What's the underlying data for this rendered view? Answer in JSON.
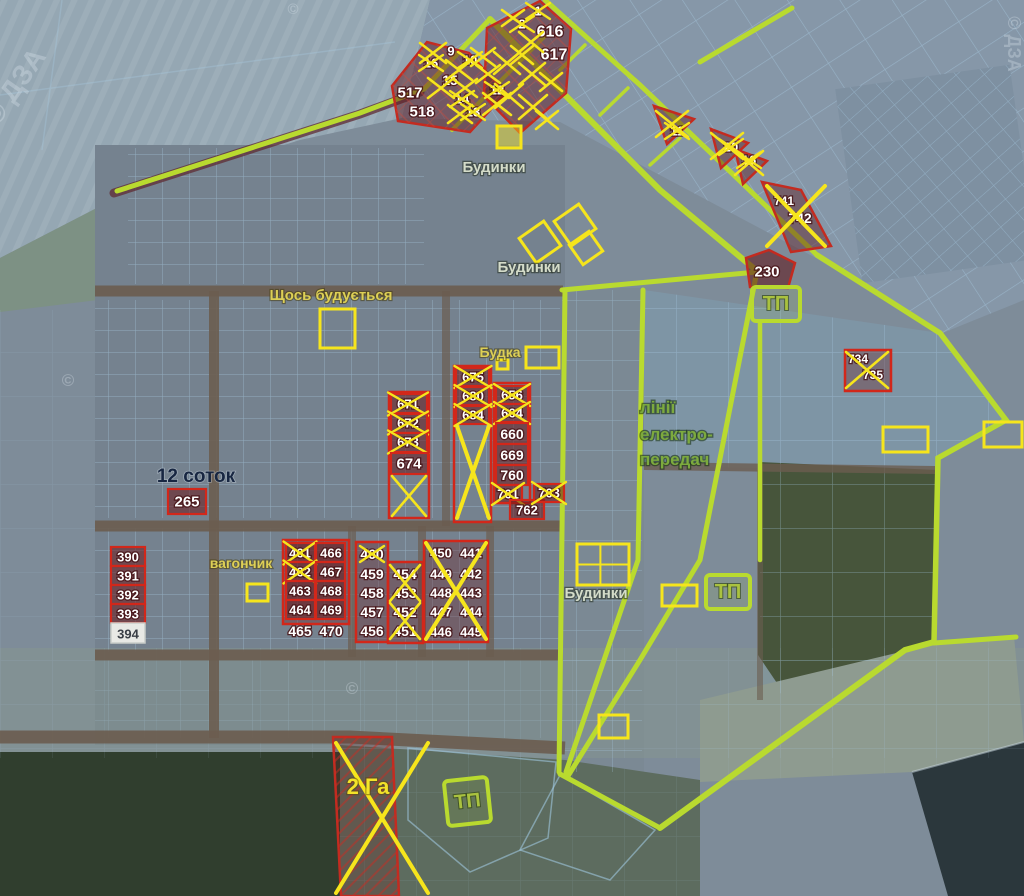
{
  "colors": {
    "lime_road": "#b9da2f",
    "yellow_mark": "#f6e51c",
    "red_plot": "#d2271a",
    "dark_red_fill": "rgba(105,25,28,0.55)",
    "grid_blue": "#a9cde6",
    "road_brown": "#6b5d50",
    "white": "#ffffff"
  },
  "tp": {
    "label": "ТП"
  },
  "watermarks": [
    {
      "text": "© ДЗА",
      "x": 22,
      "y": 92,
      "rot": -55,
      "size": 28
    },
    {
      "text": "©",
      "x": 293,
      "y": 14,
      "rot": 0,
      "size": 15
    },
    {
      "text": "©",
      "x": 68,
      "y": 386,
      "rot": 0,
      "size": 17
    },
    {
      "text": "©",
      "x": 352,
      "y": 694,
      "rot": 0,
      "size": 17
    },
    {
      "text": "© ДЗА",
      "x": 1008,
      "y": 44,
      "rot": 90,
      "size": 18
    }
  ],
  "labels": [
    {
      "id": "budynky-top",
      "text": "Будинки",
      "x": 494,
      "y": 172,
      "cls": "light",
      "size": 15
    },
    {
      "id": "budynky-mid",
      "text": "Будинки",
      "x": 529,
      "y": 272,
      "cls": "light",
      "size": 15
    },
    {
      "id": "budynky-bottom",
      "text": "Будинки",
      "x": 596,
      "y": 598,
      "cls": "light",
      "size": 15
    },
    {
      "id": "shchos-buduyetsya",
      "text": "Щось будується",
      "x": 331,
      "y": 300,
      "cls": "yellow",
      "size": 15
    },
    {
      "id": "budka",
      "text": "Будка",
      "x": 500,
      "y": 357,
      "cls": "yellow",
      "size": 14
    },
    {
      "id": "power-line-1",
      "text": "лінії",
      "x": 640,
      "y": 413,
      "cls": "green",
      "size": 17,
      "anchor": "start"
    },
    {
      "id": "power-line-2",
      "text": "електро-",
      "x": 640,
      "y": 440,
      "cls": "green",
      "size": 17,
      "anchor": "start"
    },
    {
      "id": "power-line-3",
      "text": "передач",
      "x": 640,
      "y": 465,
      "cls": "green",
      "size": 17,
      "anchor": "start"
    },
    {
      "id": "sotok-12",
      "text": "12 соток",
      "x": 196,
      "y": 482,
      "cls": "dark",
      "size": 19
    },
    {
      "id": "vagonchyk",
      "text": "вагончик",
      "x": 241,
      "y": 568,
      "cls": "yellow",
      "size": 14
    },
    {
      "id": "ga-2",
      "text": "2 Га",
      "x": 368,
      "y": 794,
      "cls": "ybig",
      "size": 22
    }
  ],
  "plots": [
    {
      "n": "9",
      "x": 451,
      "y": 51,
      "style": "t",
      "size": 13
    },
    {
      "n": "16",
      "x": 431,
      "y": 63,
      "style": "t",
      "size": 13,
      "crossed": true
    },
    {
      "n": "10",
      "x": 470,
      "y": 60,
      "style": "t",
      "size": 13,
      "crossed": true
    },
    {
      "n": "15",
      "x": 450,
      "y": 80,
      "style": "t",
      "size": 14
    },
    {
      "n": "517",
      "x": 410,
      "y": 93,
      "style": "t",
      "size": 15
    },
    {
      "n": "518",
      "x": 422,
      "y": 112,
      "style": "t",
      "size": 15
    },
    {
      "n": "14",
      "x": 462,
      "y": 99,
      "style": "t",
      "size": 13,
      "crossed": true
    },
    {
      "n": "13",
      "x": 473,
      "y": 112,
      "style": "t",
      "size": 13,
      "crossed": true
    },
    {
      "n": "12",
      "x": 497,
      "y": 90,
      "style": "t",
      "size": 13,
      "crossed": true
    },
    {
      "n": "1",
      "x": 538,
      "y": 11,
      "style": "t",
      "size": 13,
      "crossed": true
    },
    {
      "n": "2",
      "x": 522,
      "y": 24,
      "style": "t",
      "size": 13,
      "crossed": true
    },
    {
      "n": "616",
      "x": 550,
      "y": 32,
      "style": "t",
      "size": 16
    },
    {
      "n": "617",
      "x": 554,
      "y": 55,
      "style": "t",
      "size": 16
    },
    {
      "n": "11",
      "x": 677,
      "y": 131,
      "style": "t",
      "size": 13,
      "crossed": true
    },
    {
      "n": "20",
      "x": 731,
      "y": 147,
      "style": "t",
      "size": 13,
      "crossed": true
    },
    {
      "n": "16",
      "x": 749,
      "y": 160,
      "style": "t",
      "size": 13,
      "crossed": true
    },
    {
      "n": "741",
      "x": 784,
      "y": 201,
      "style": "t",
      "size": 12
    },
    {
      "n": "742",
      "x": 800,
      "y": 218,
      "style": "t",
      "size": 14
    },
    {
      "n": "230",
      "x": 767,
      "y": 272,
      "style": "t",
      "size": 15
    },
    {
      "n": "734",
      "x": 858,
      "y": 359,
      "style": "t",
      "size": 12
    },
    {
      "n": "735",
      "x": 873,
      "y": 375,
      "style": "t",
      "size": 12
    },
    {
      "n": "671",
      "x": 408,
      "y": 404,
      "box": [
        391,
        394,
        36,
        19
      ],
      "style": "r",
      "size": 13,
      "crossed": true
    },
    {
      "n": "672",
      "x": 408,
      "y": 423,
      "box": [
        391,
        414,
        36,
        19
      ],
      "style": "r",
      "size": 13,
      "crossed": true
    },
    {
      "n": "673",
      "x": 408,
      "y": 442,
      "box": [
        391,
        433,
        36,
        19
      ],
      "style": "r",
      "size": 13,
      "crossed": true
    },
    {
      "n": "674",
      "x": 409,
      "y": 464,
      "box": [
        391,
        453,
        37,
        21
      ],
      "style": "r",
      "size": 15
    },
    {
      "n": "675",
      "x": 473,
      "y": 377,
      "box": [
        456,
        368,
        33,
        18
      ],
      "style": "r",
      "size": 13,
      "crossed": true
    },
    {
      "n": "680",
      "x": 473,
      "y": 396,
      "box": [
        456,
        387,
        33,
        18
      ],
      "style": "r",
      "size": 13,
      "crossed": true
    },
    {
      "n": "684",
      "x": 473,
      "y": 415,
      "box": [
        456,
        406,
        33,
        18
      ],
      "style": "r",
      "size": 13,
      "crossed": true
    },
    {
      "n": "656",
      "x": 512,
      "y": 395,
      "box": [
        496,
        386,
        32,
        18
      ],
      "style": "r",
      "size": 13,
      "crossed": true
    },
    {
      "n": "664",
      "x": 512,
      "y": 413,
      "box": [
        496,
        404,
        32,
        18
      ],
      "style": "r",
      "size": 13,
      "crossed": true
    },
    {
      "n": "660",
      "x": 512,
      "y": 434,
      "box": [
        496,
        423,
        32,
        21
      ],
      "style": "r",
      "size": 14
    },
    {
      "n": "669",
      "x": 512,
      "y": 455,
      "box": [
        496,
        444,
        32,
        21
      ],
      "style": "r",
      "size": 14
    },
    {
      "n": "760",
      "x": 512,
      "y": 475,
      "box": [
        496,
        465,
        32,
        20
      ],
      "style": "r",
      "size": 14
    },
    {
      "n": "761",
      "x": 508,
      "y": 494,
      "box": [
        494,
        485,
        28,
        18
      ],
      "style": "r",
      "size": 13,
      "crossed": true
    },
    {
      "n": "762",
      "x": 527,
      "y": 510,
      "box": [
        510,
        500,
        34,
        19
      ],
      "style": "r",
      "size": 13
    },
    {
      "n": "763",
      "x": 549,
      "y": 493,
      "box": [
        534,
        484,
        30,
        18
      ],
      "style": "r",
      "size": 13,
      "crossed": true
    },
    {
      "n": "265",
      "x": 187,
      "y": 502,
      "box": [
        168,
        489,
        38,
        25
      ],
      "style": "r",
      "size": 15
    },
    {
      "n": "390",
      "x": 128,
      "y": 557,
      "box": [
        111,
        547,
        34,
        19
      ],
      "style": "r",
      "size": 13
    },
    {
      "n": "391",
      "x": 128,
      "y": 576,
      "box": [
        111,
        566,
        34,
        19
      ],
      "style": "r",
      "size": 13
    },
    {
      "n": "392",
      "x": 128,
      "y": 595,
      "box": [
        111,
        585,
        34,
        19
      ],
      "style": "r",
      "size": 13
    },
    {
      "n": "393",
      "x": 128,
      "y": 614,
      "box": [
        111,
        604,
        34,
        19
      ],
      "style": "r",
      "size": 13
    },
    {
      "n": "394",
      "x": 128,
      "y": 634,
      "box": [
        111,
        623,
        34,
        20
      ],
      "style": "w",
      "size": 13
    },
    {
      "n": "461",
      "x": 300,
      "y": 553,
      "box": [
        286,
        543,
        29,
        19
      ],
      "style": "r",
      "size": 13,
      "crossed": true
    },
    {
      "n": "466",
      "x": 331,
      "y": 553,
      "box": [
        316,
        543,
        29,
        19
      ],
      "style": "r",
      "size": 13
    },
    {
      "n": "462",
      "x": 300,
      "y": 572,
      "box": [
        286,
        562,
        29,
        19
      ],
      "style": "r",
      "size": 13,
      "crossed": true
    },
    {
      "n": "467",
      "x": 331,
      "y": 572,
      "box": [
        316,
        562,
        29,
        19
      ],
      "style": "r",
      "size": 13
    },
    {
      "n": "463",
      "x": 300,
      "y": 591,
      "box": [
        286,
        581,
        29,
        19
      ],
      "style": "r",
      "size": 13
    },
    {
      "n": "468",
      "x": 331,
      "y": 591,
      "box": [
        316,
        581,
        29,
        19
      ],
      "style": "r",
      "size": 13
    },
    {
      "n": "464",
      "x": 300,
      "y": 610,
      "box": [
        286,
        600,
        29,
        19
      ],
      "style": "r",
      "size": 13
    },
    {
      "n": "469",
      "x": 331,
      "y": 610,
      "box": [
        316,
        600,
        29,
        19
      ],
      "style": "r",
      "size": 13
    },
    {
      "n": "465",
      "x": 300,
      "y": 631,
      "style": "t",
      "size": 14
    },
    {
      "n": "470",
      "x": 331,
      "y": 631,
      "style": "t",
      "size": 14
    },
    {
      "n": "460",
      "x": 372,
      "y": 554,
      "style": "t",
      "size": 14,
      "crossed": true
    },
    {
      "n": "459",
      "x": 372,
      "y": 574,
      "style": "t",
      "size": 14
    },
    {
      "n": "458",
      "x": 372,
      "y": 593,
      "style": "t",
      "size": 14
    },
    {
      "n": "457",
      "x": 372,
      "y": 612,
      "style": "t",
      "size": 14
    },
    {
      "n": "456",
      "x": 372,
      "y": 631,
      "style": "t",
      "size": 14
    },
    {
      "n": "454",
      "x": 405,
      "y": 574,
      "style": "t",
      "size": 14
    },
    {
      "n": "453",
      "x": 405,
      "y": 593,
      "style": "t",
      "size": 14
    },
    {
      "n": "452",
      "x": 405,
      "y": 612,
      "style": "t",
      "size": 14
    },
    {
      "n": "451",
      "x": 405,
      "y": 631,
      "style": "t",
      "size": 14
    },
    {
      "n": "450",
      "x": 441,
      "y": 553,
      "style": "t",
      "size": 13
    },
    {
      "n": "449",
      "x": 441,
      "y": 574,
      "style": "t",
      "size": 13
    },
    {
      "n": "448",
      "x": 441,
      "y": 593,
      "style": "t",
      "size": 13
    },
    {
      "n": "447",
      "x": 441,
      "y": 612,
      "style": "t",
      "size": 13
    },
    {
      "n": "446",
      "x": 441,
      "y": 632,
      "style": "t",
      "size": 13
    },
    {
      "n": "441",
      "x": 471,
      "y": 553,
      "style": "t",
      "size": 13
    },
    {
      "n": "442",
      "x": 471,
      "y": 574,
      "style": "t",
      "size": 13
    },
    {
      "n": "443",
      "x": 471,
      "y": 593,
      "style": "t",
      "size": 13
    },
    {
      "n": "444",
      "x": 471,
      "y": 612,
      "style": "t",
      "size": 13
    },
    {
      "n": "445",
      "x": 471,
      "y": 632,
      "style": "t",
      "size": 13
    }
  ],
  "block_outlines": [
    {
      "box": [
        283,
        540,
        66,
        84
      ],
      "fill": true
    },
    {
      "box": [
        356,
        542,
        32,
        100
      ],
      "fill": true
    },
    {
      "box": [
        388,
        562,
        35,
        81
      ],
      "fill": true
    },
    {
      "box": [
        424,
        541,
        64,
        101
      ],
      "fill": true
    },
    {
      "box": [
        845,
        350,
        46,
        41
      ],
      "fill": true
    },
    {
      "box": [
        389,
        392,
        40,
        126
      ],
      "fill": false
    },
    {
      "box": [
        454,
        366,
        37,
        156
      ],
      "fill": false
    },
    {
      "box": [
        494,
        383,
        36,
        120
      ],
      "fill": false
    }
  ],
  "x_marks": [
    {
      "x": 433,
      "y": 53,
      "w": 26,
      "h": 20
    },
    {
      "x": 459,
      "y": 70,
      "w": 26,
      "h": 20
    },
    {
      "x": 483,
      "y": 57,
      "w": 24,
      "h": 18
    },
    {
      "x": 441,
      "y": 88,
      "w": 26,
      "h": 20
    },
    {
      "x": 465,
      "y": 88,
      "w": 24,
      "h": 18
    },
    {
      "x": 488,
      "y": 74,
      "w": 24,
      "h": 18
    },
    {
      "x": 497,
      "y": 104,
      "w": 28,
      "h": 22
    },
    {
      "x": 460,
      "y": 114,
      "w": 24,
      "h": 18
    },
    {
      "x": 513,
      "y": 18,
      "w": 22,
      "h": 16
    },
    {
      "x": 531,
      "y": 42,
      "w": 24,
      "h": 20
    },
    {
      "x": 507,
      "y": 63,
      "w": 26,
      "h": 22
    },
    {
      "x": 532,
      "y": 74,
      "w": 26,
      "h": 22
    },
    {
      "x": 551,
      "y": 82,
      "w": 22,
      "h": 18
    },
    {
      "x": 509,
      "y": 96,
      "w": 28,
      "h": 24
    },
    {
      "x": 533,
      "y": 107,
      "w": 28,
      "h": 24
    },
    {
      "x": 547,
      "y": 120,
      "w": 22,
      "h": 18
    },
    {
      "x": 522,
      "y": 55,
      "w": 22,
      "h": 18
    },
    {
      "x": 672,
      "y": 124,
      "w": 32,
      "h": 26
    },
    {
      "x": 727,
      "y": 146,
      "w": 32,
      "h": 26
    },
    {
      "x": 749,
      "y": 163,
      "w": 28,
      "h": 24
    },
    {
      "x": 796,
      "y": 216,
      "w": 58,
      "h": 60
    },
    {
      "x": 867,
      "y": 370,
      "w": 42,
      "h": 36
    },
    {
      "x": 409,
      "y": 496,
      "w": 34,
      "h": 40
    },
    {
      "x": 473,
      "y": 472,
      "w": 32,
      "h": 92
    },
    {
      "x": 405,
      "y": 583,
      "w": 30,
      "h": 36
    },
    {
      "x": 405,
      "y": 621,
      "w": 30,
      "h": 36
    },
    {
      "x": 456,
      "y": 591,
      "w": 60,
      "h": 96
    },
    {
      "x": 382,
      "y": 818,
      "w": 92,
      "h": 150
    }
  ],
  "highlights": [
    {
      "box": [
        497,
        126,
        24,
        22
      ],
      "fill": true
    },
    {
      "box": [
        525,
        227,
        30,
        30
      ],
      "rot": -35
    },
    {
      "box": [
        560,
        210,
        30,
        30
      ],
      "rot": -35
    },
    {
      "box": [
        574,
        236,
        24,
        24
      ],
      "rot": -35
    },
    {
      "box": [
        320,
        309,
        35,
        39
      ]
    },
    {
      "box": [
        497,
        360,
        11,
        9
      ]
    },
    {
      "box": [
        526,
        347,
        33,
        21
      ]
    },
    {
      "box": [
        577,
        544,
        52,
        41
      ],
      "grid": true
    },
    {
      "box": [
        662,
        585,
        35,
        21
      ]
    },
    {
      "box": [
        599,
        715,
        29,
        23
      ]
    },
    {
      "box": [
        883,
        427,
        45,
        25
      ]
    },
    {
      "box": [
        984,
        422,
        38,
        25
      ]
    },
    {
      "box": [
        247,
        584,
        21,
        17
      ]
    }
  ],
  "tp_boxes": [
    {
      "x": 752,
      "y": 287,
      "w": 48,
      "h": 34,
      "rot": 0
    },
    {
      "x": 706,
      "y": 575,
      "w": 44,
      "h": 34,
      "rot": 0
    },
    {
      "x": 446,
      "y": 779,
      "w": 43,
      "h": 45,
      "rot": -6
    }
  ]
}
